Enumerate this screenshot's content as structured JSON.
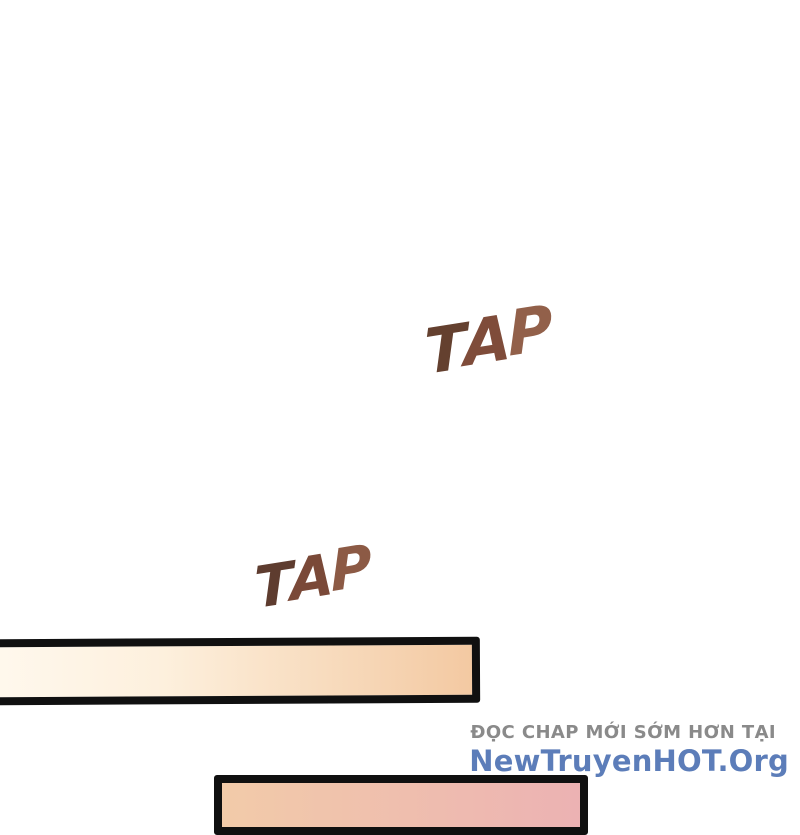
{
  "page": {
    "background_color": "#ffffff",
    "type": "webtoon-comic-strip"
  },
  "sound_effects": [
    {
      "text": "TAP",
      "letters": [
        "T",
        "A",
        "P"
      ],
      "letter_colors": [
        "#64402f",
        "#7f4c3a",
        "#92604a"
      ],
      "style": "brush-brown-rotated"
    },
    {
      "text": "TAP",
      "letters": [
        "T",
        "A",
        "P"
      ],
      "letter_colors": [
        "#5e3c2f",
        "#7a4938",
        "#8c5a45"
      ],
      "style": "brush-brown-rotated"
    }
  ],
  "panels": [
    {
      "name": "cream-bar",
      "border_color": "#101010",
      "fill_gradient_start": "#fff8ed",
      "fill_gradient_end": "#f3c9a2",
      "clipped_edge": "left"
    },
    {
      "name": "pink-bar",
      "border_color": "#101010",
      "fill_gradient_start": "#f2cba9",
      "fill_gradient_end": "#ecb2b3",
      "clipped_edge": "bottom"
    }
  ],
  "watermark": {
    "tagline": "ĐỌC CHAP MỚI SỚM HƠN TẠI",
    "tagline_color": "#8a8a8a",
    "site": "NewTruyenHOT.Org",
    "site_color": "#5c7db9"
  }
}
